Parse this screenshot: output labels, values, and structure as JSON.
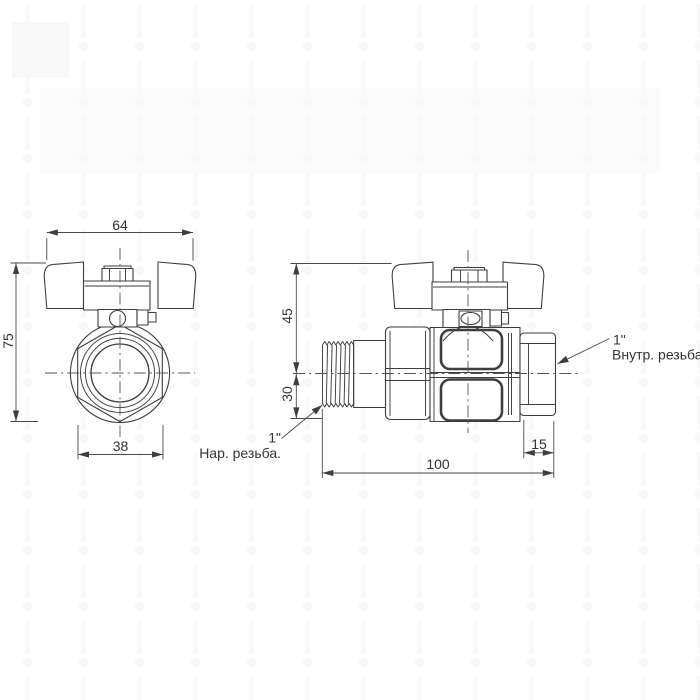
{
  "drawing": {
    "dims": {
      "front_width": "64",
      "front_height": "75",
      "front_flats": "38",
      "side_upper": "45",
      "side_lower": "30",
      "side_length": "100",
      "side_cap": "15"
    },
    "labels": {
      "male_size": "1\"",
      "male_thread": "Нар. резьба.",
      "female_size": "1\"",
      "female_thread": "Внутр. резьба."
    },
    "colors": {
      "line": "#3e3e3e",
      "text": "#333333",
      "centerline": "#555555",
      "background": "#ffffff",
      "watermark": "#f7f7f7"
    }
  }
}
